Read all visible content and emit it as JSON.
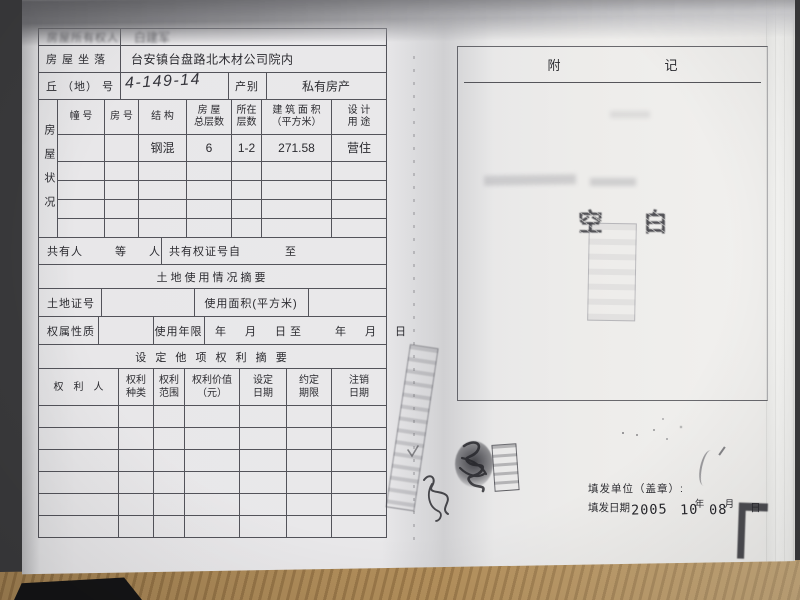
{
  "page_left": {
    "owner_row": {
      "label": "房屋所有权人",
      "value": "白建军"
    },
    "location_row": {
      "label": "房 屋 坐 落",
      "value": "台安镇台盘路北木材公司院内"
    },
    "plot_row": {
      "label": "丘 （地） 号",
      "value": "4-149-14",
      "category_label": "产别",
      "category_value": "私有房产"
    },
    "status_label": "房屋状况",
    "grid_headers": {
      "building": "幢 号",
      "room": "房 号",
      "structure": "结 构",
      "total_floors": "房 屋\n总层数",
      "floor": "所在\n层数",
      "area": "建 筑 面 积\n（平方米）",
      "use": "设 计\n用 途"
    },
    "grid_row": {
      "structure": "钢混",
      "total_floors": "6",
      "floor": "1-2",
      "area": "271.58",
      "use": "营住"
    },
    "co_owner": {
      "label": "共有人",
      "etc": "等",
      "person": "人",
      "cert_label": "共有权证号自",
      "to": "至"
    },
    "land_title": "土地使用情况摘要",
    "land_row": {
      "cert_label": "土地证号",
      "area_label": "使用面积(平方米)"
    },
    "tenure_row": {
      "label": "权属性质",
      "years_label": "使用年限",
      "dates": "年　月　日至　　年　月　日"
    },
    "lien_title": "设 定 他 项 权 利 摘 要",
    "lien_headers": {
      "holder": "权　利　人",
      "kind": "权利\n种类",
      "scope": "权利\n范围",
      "value": "权利价值\n（元）",
      "set_date": "设定\n日期",
      "term": "约定\n期限",
      "cancel_date": "注销\n日期"
    },
    "lien_empty_rows": 6
  },
  "page_right": {
    "title": "附记",
    "blank_stamp": "空白",
    "issuer_label": "填发单位（盖章）:",
    "date_label": "填发日期",
    "date_stamp": {
      "year": "2005",
      "month": "10",
      "day": "08"
    },
    "date_units": {
      "year": "年",
      "month": "月",
      "day": "日"
    }
  }
}
